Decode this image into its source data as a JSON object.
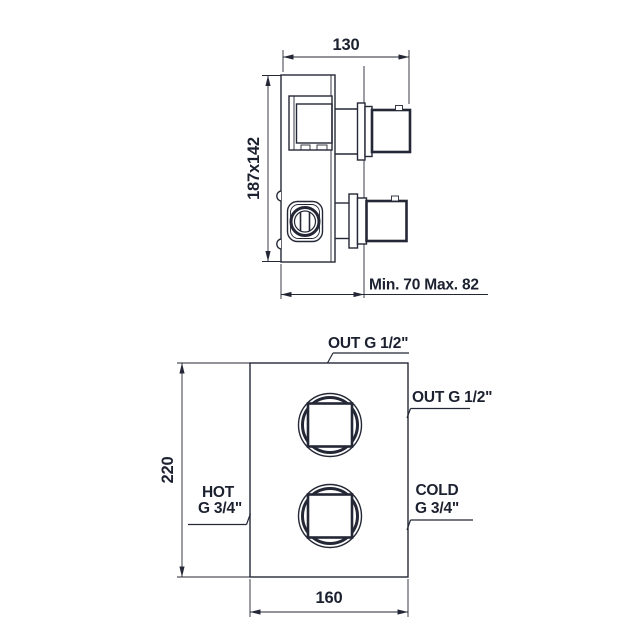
{
  "drawing": {
    "side_view": {
      "dim_width": "130",
      "dim_plate": "187x142",
      "dim_depth": "Min. 70 Max. 82"
    },
    "front_view": {
      "dim_height": "220",
      "dim_width": "160",
      "label_out_top": "OUT G 1/2\"",
      "label_out_right": "OUT G 1/2\"",
      "label_hot_1": "HOT",
      "label_hot_2": "G 3/4\"",
      "label_cold_1": "COLD",
      "label_cold_2": "G 3/4\""
    },
    "colors": {
      "line": "#242836",
      "text": "#1c2130",
      "background": "#ffffff"
    }
  }
}
